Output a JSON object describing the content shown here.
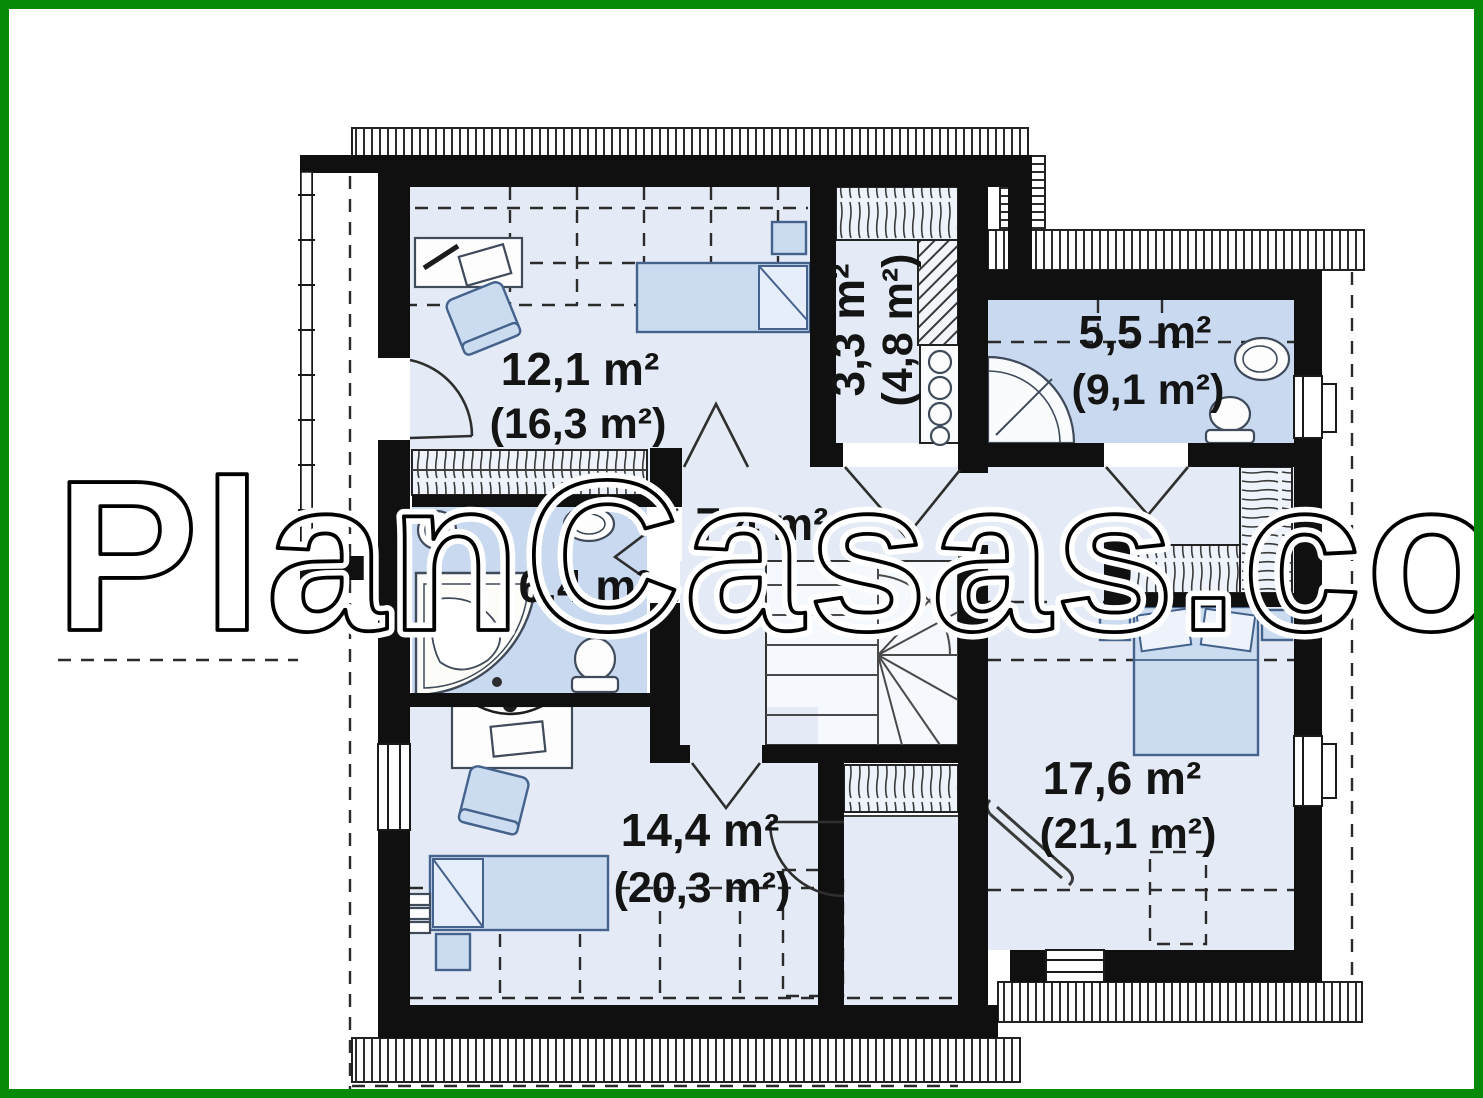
{
  "watermark": {
    "text": "PlanCasas.com"
  },
  "plan": {
    "type": "floor-plan",
    "rooms": [
      {
        "id": "bedroom-top-left",
        "area": "12,1 m²",
        "area_total": "(16,3 m²)"
      },
      {
        "id": "storage-closet",
        "area": "3,3 m²",
        "area_total": "(4,8 m²)"
      },
      {
        "id": "bathroom-top-right",
        "area": "5,5 m²",
        "area_total": "(9,1 m²)"
      },
      {
        "id": "hall-landing",
        "area": "7,4 m²"
      },
      {
        "id": "bathroom-middle",
        "area": "6,4 m²"
      },
      {
        "id": "bedroom-bottom-left",
        "area": "14,4 m²",
        "area_total": "(20,3 m²)"
      },
      {
        "id": "bedroom-right",
        "area": "17,6 m²",
        "area_total": "(21,1 m²)"
      }
    ],
    "colors": {
      "frame": "#078a07",
      "wall": "#101010",
      "floor": "#e4ebf6",
      "wet": "#c9daf0",
      "furniture": "#ccdcf0",
      "stair": "#f5f8fc"
    }
  }
}
